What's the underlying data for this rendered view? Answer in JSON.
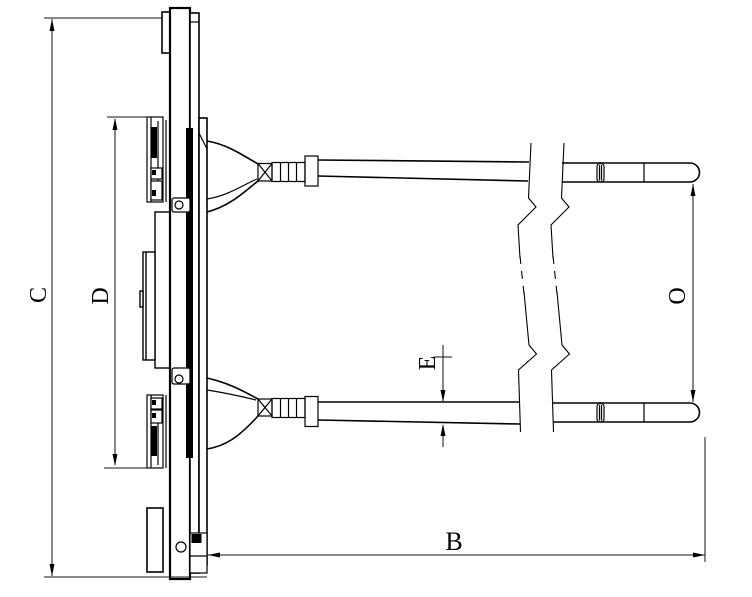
{
  "drawing": {
    "background_color": "#ffffff",
    "line_color": "#000000",
    "dimension_labels": {
      "overall_height": "C",
      "inner_height": "D",
      "arm_thickness": "E",
      "arm_length": "B",
      "jaw_opening": "O"
    }
  }
}
